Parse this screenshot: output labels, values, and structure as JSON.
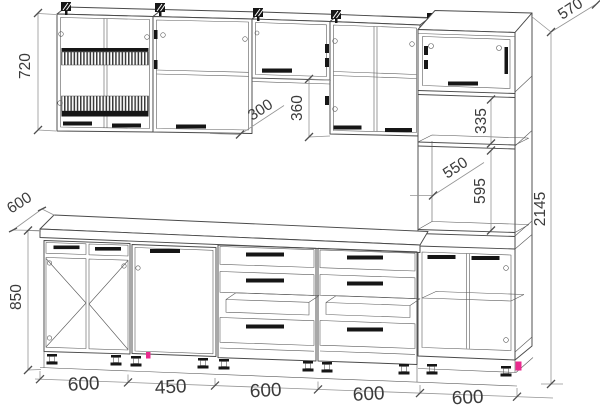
{
  "drawing": {
    "type": "kitchen-elevation-technical-drawing",
    "dimensions": {
      "wall_cabinet_height": "720",
      "wall_cabinet_depth": "300",
      "hood_cabinet_height": "360",
      "tall_upper_section_height": "335",
      "tall_cabinet_depth": "570",
      "appliance_niche_depth": "550",
      "appliance_niche_height": "595",
      "total_height": "2145",
      "worktop_depth": "600",
      "base_cabinet_height": "850",
      "module_widths": [
        "600",
        "450",
        "600",
        "600",
        "600"
      ]
    },
    "colors": {
      "line": "#4a4a4a",
      "dimension_line": "#949494",
      "text": "#3b3b3b",
      "detail_black": "#161616",
      "accent_magenta": "#ea2a8e",
      "background": "#ffffff"
    }
  }
}
